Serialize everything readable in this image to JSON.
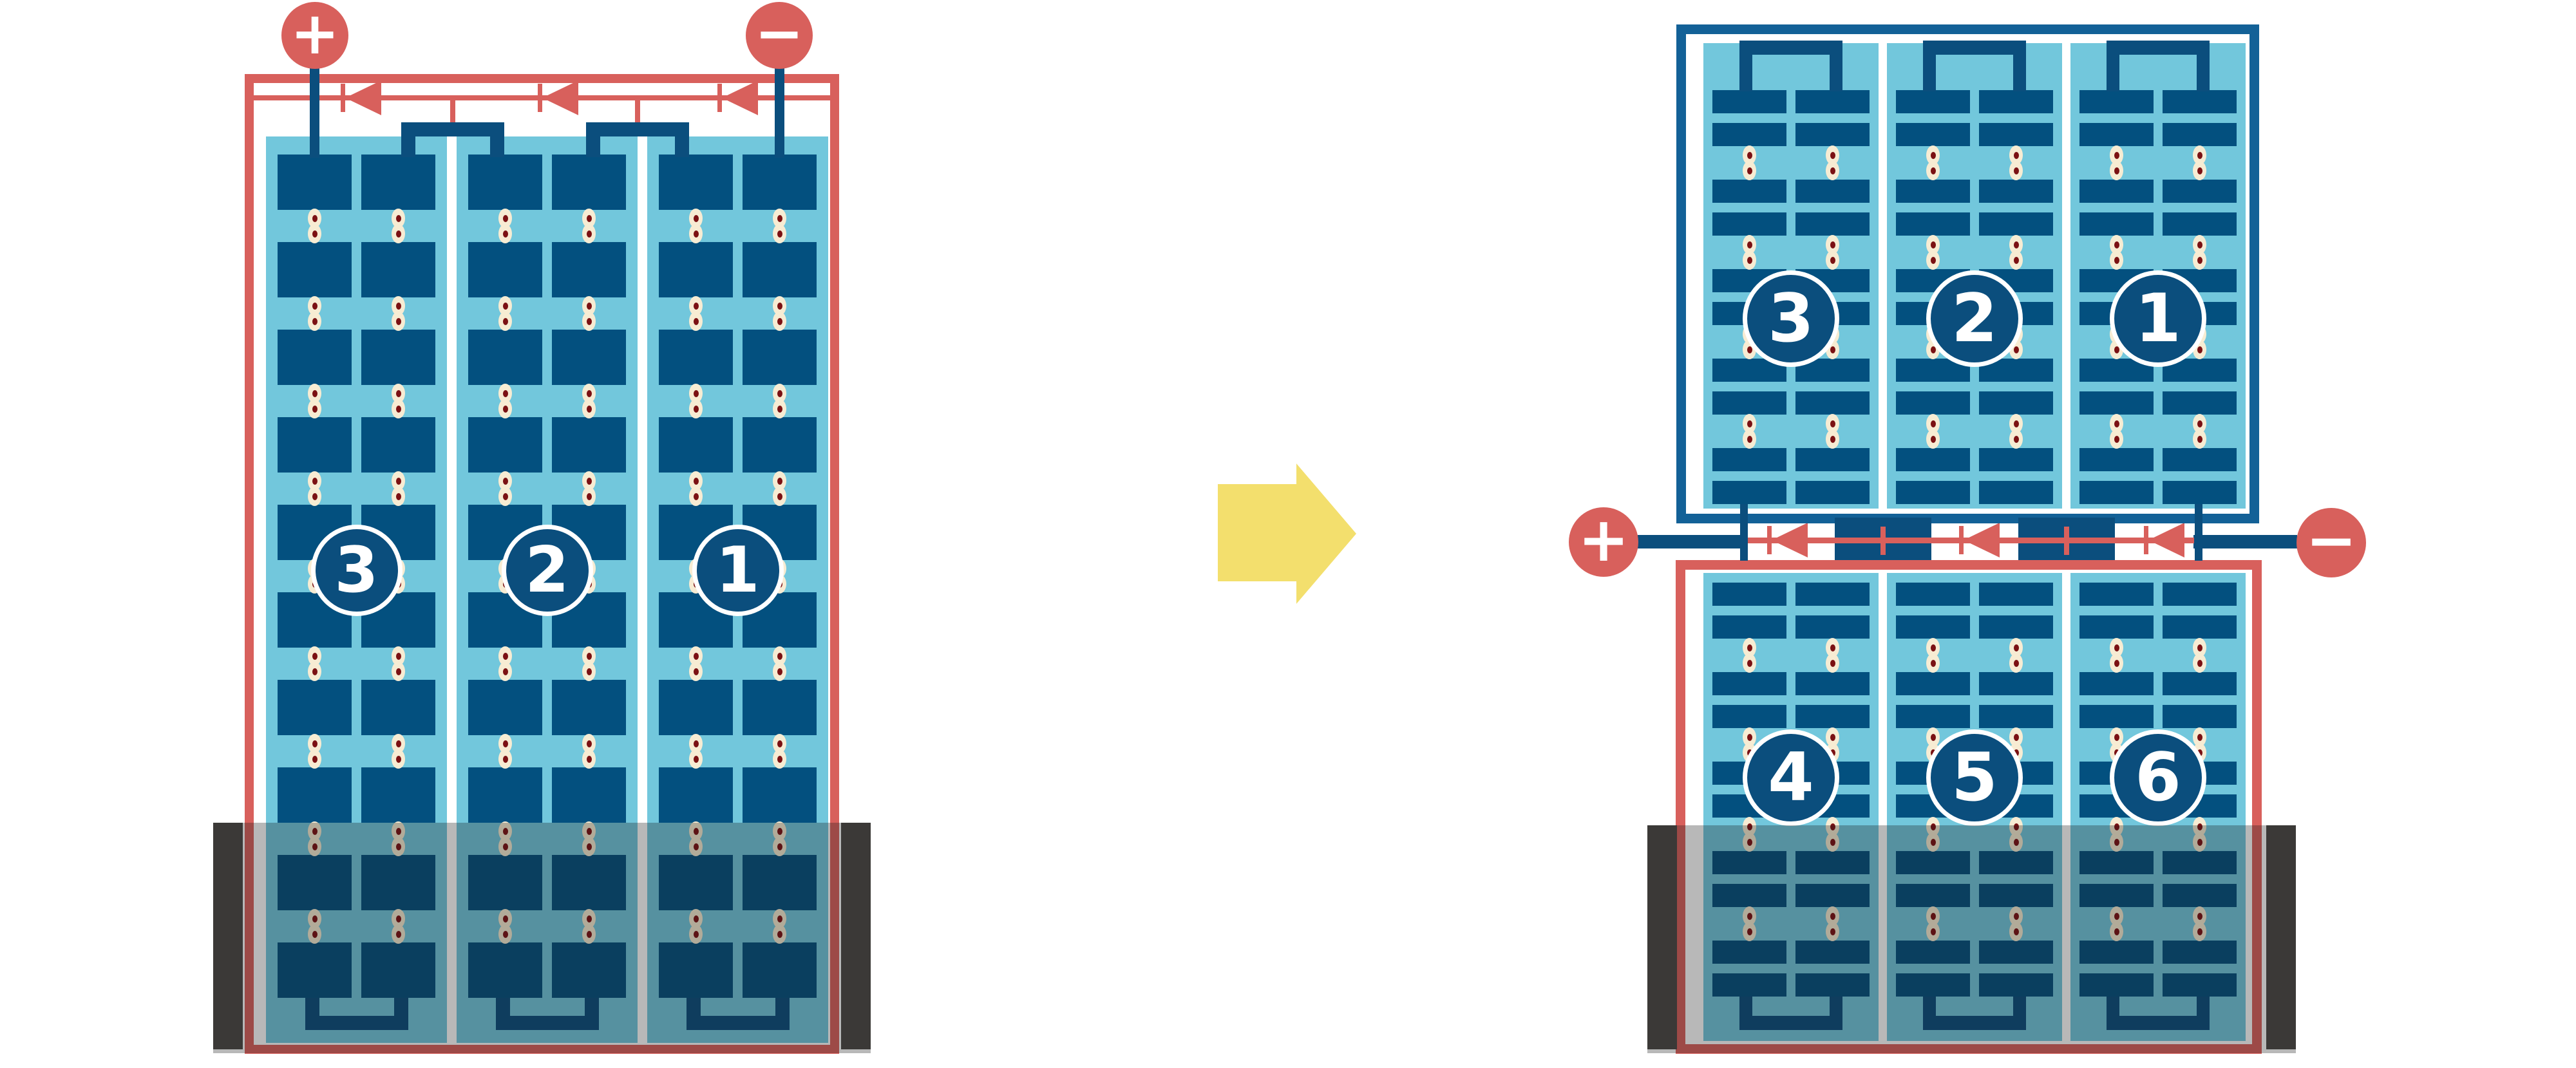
{
  "diagram": {
    "title": "",
    "left_module": {
      "kind": "full-cell-module",
      "terminal_positive": "+",
      "terminal_negative": "−",
      "string_labels": [
        "3",
        "2",
        "1"
      ],
      "string_count": 3,
      "columns_per_string": 2,
      "cell_rows": 10,
      "bypass_diode_count": 3,
      "shaded_lower_portion": true
    },
    "arrow": {
      "direction": "right"
    },
    "right_module": {
      "kind": "half-cut-cell-module",
      "top_half": {
        "string_labels": [
          "3",
          "2",
          "1"
        ],
        "string_count": 3,
        "columns_per_string": 2,
        "half_cell_pairs": 5
      },
      "junction": {
        "terminal_positive": "+",
        "terminal_negative": "−",
        "bypass_diode_count": 3
      },
      "bottom_half": {
        "string_labels": [
          "4",
          "5",
          "6"
        ],
        "string_count": 3,
        "columns_per_string": 2,
        "half_cell_pairs": 5
      },
      "shaded_lower_portion": true
    },
    "colors": {
      "red": "#D8605C",
      "wire_navy": "#0B4E7D",
      "cell_navy": "#03507F",
      "frame_blue": "#136197",
      "panel_light_blue": "#72C7DC",
      "dot_cream": "#F7ECD3",
      "dot_core": "#7B1113",
      "arrow_yellow": "#F3DF6D",
      "shade_overlay": "rgba(25,25,25,0.31)",
      "shade_bar": "#3B3937",
      "label_white": "#FFFFFF"
    }
  }
}
